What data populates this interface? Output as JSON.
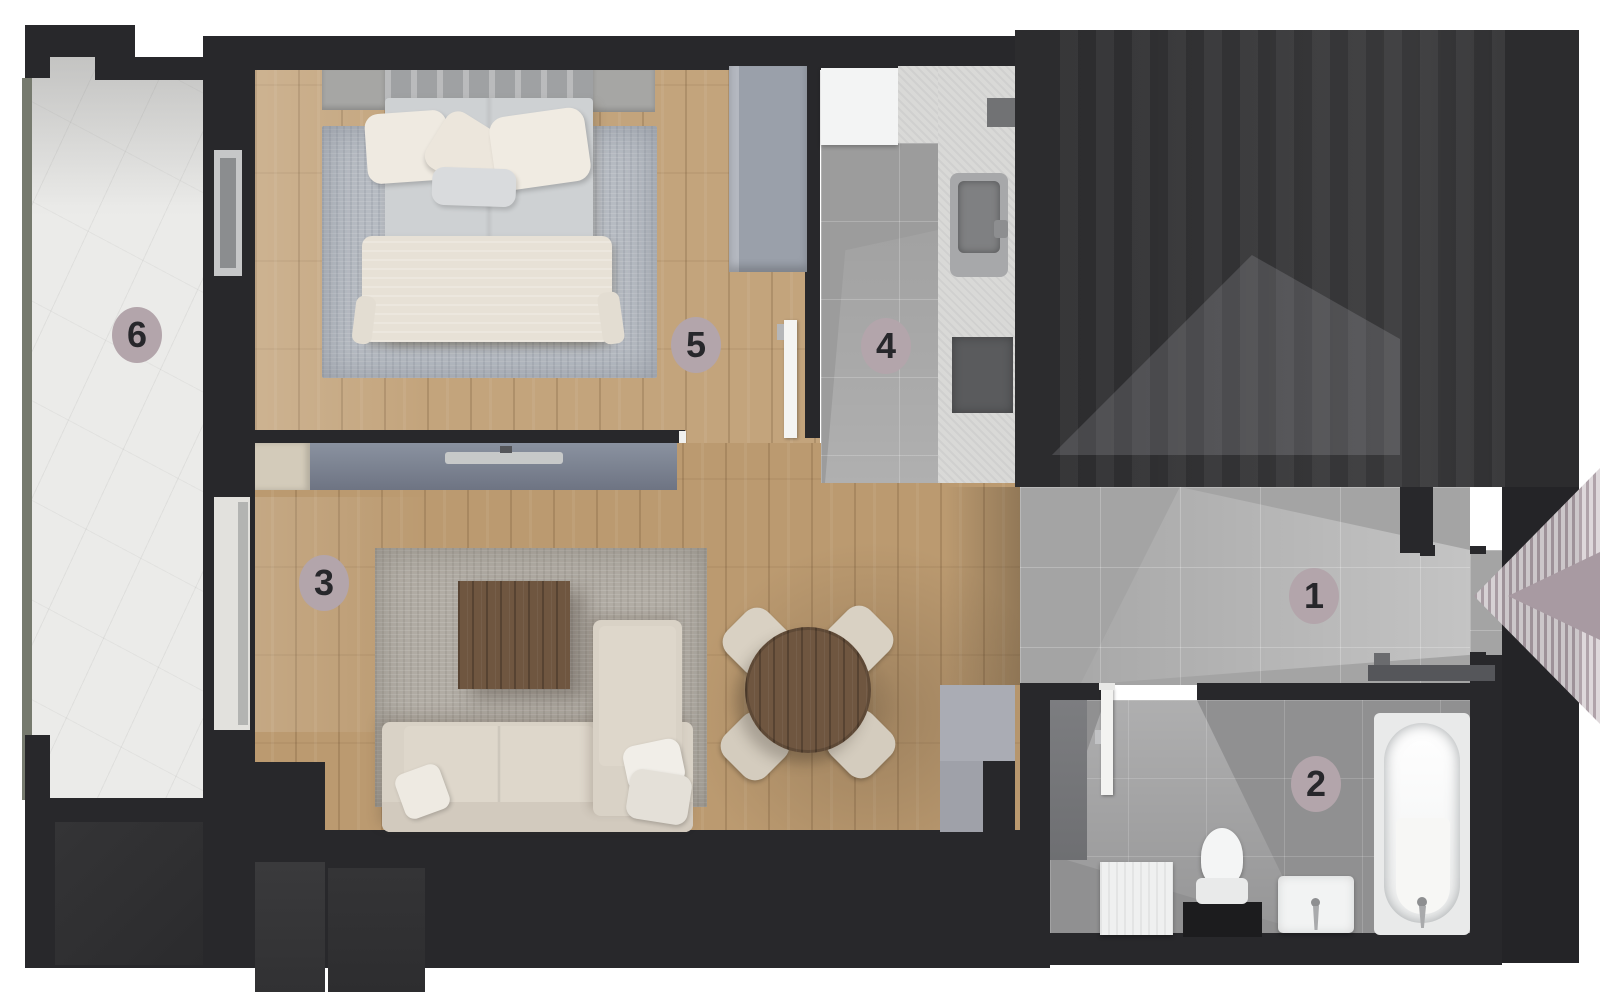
{
  "floorplan": {
    "title": "apartment-floor-plan",
    "markers": [
      {
        "id": "hallway",
        "label": "1"
      },
      {
        "id": "bathroom",
        "label": "2"
      },
      {
        "id": "living-room",
        "label": "3"
      },
      {
        "id": "kitchen",
        "label": "4"
      },
      {
        "id": "bedroom",
        "label": "5"
      },
      {
        "id": "balcony",
        "label": "6"
      }
    ],
    "marker_style": {
      "fill": "#b3a5ab",
      "text_color": "#27272b"
    },
    "icons": {
      "entrance": "left-arrow"
    },
    "colors": {
      "background": "#ffffff",
      "wall": "#28282b",
      "wood_floor": "#c3a47c",
      "hall_tile": "#a4a4a4",
      "kitchen_tile": "#9c9c9c",
      "bath_tile": "#909091",
      "balcony_marble": "#ebebe9",
      "counter": "#d9d9d7",
      "rug_bedroom": "#b6bbc2",
      "rug_living": "#b1aca4",
      "sofa": "#d9d2c6",
      "blanket": "#e7e1d6",
      "table_wood": "#6f5640",
      "tv_console": "#7e8695",
      "wardrobe": "#9aa0aa",
      "dark_zone": "#2c2c2e",
      "dark_zone_light": "#47474a",
      "entrance_accent": "#a89aa2"
    }
  }
}
